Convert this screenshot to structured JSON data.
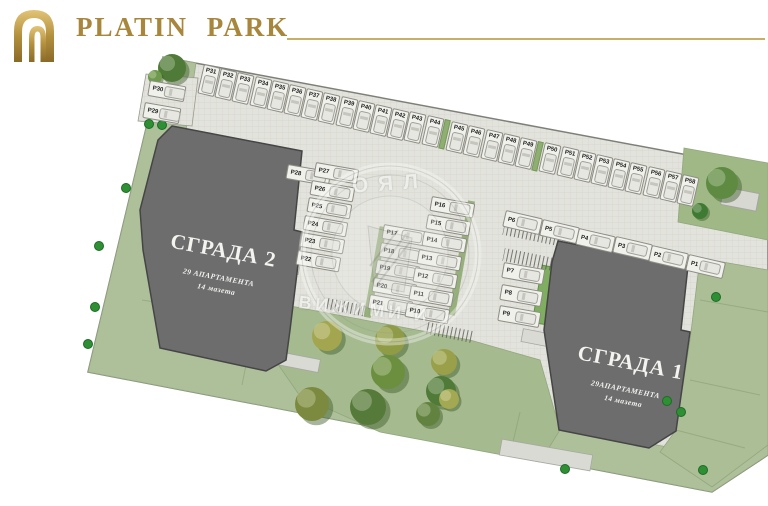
{
  "header": {
    "brand": "PLATIN PARK"
  },
  "watermark": {
    "arc_text": "ОЯЛ",
    "band_text": "ВИЖИМИ И"
  },
  "buildings": {
    "b2": {
      "name": "СГРАДА 2",
      "line1": "29 АПАРТАМЕНТА",
      "line2": "14 мазета"
    },
    "b1": {
      "name": "СГРАДА 1",
      "line1": "29АПАРТАМЕНТА",
      "line2": "14 мазета"
    }
  },
  "parking": {
    "top_row": [
      "P31",
      "P32",
      "P33",
      "P34",
      "P35",
      "P36",
      "P37",
      "P38",
      "P39",
      "P40",
      "P41",
      "P42",
      "P43",
      "P44",
      "P45",
      "P46",
      "P47",
      "P48",
      "P49",
      "P50",
      "P51",
      "P52",
      "P53",
      "P54",
      "P55",
      "P56",
      "P57",
      "P58"
    ],
    "left_edge": [
      "P30",
      "P29"
    ],
    "col_single": [
      "P28"
    ],
    "col_a": [
      "P27",
      "P26",
      "P25",
      "P24",
      "P23",
      "P22"
    ],
    "col_b": [
      "P17",
      "P18",
      "P19",
      "P20",
      "P21"
    ],
    "col_c": [
      "P16",
      "P15",
      "P14",
      "P13",
      "P12",
      "P11",
      "P10"
    ],
    "b1_col": [
      "P7",
      "P8",
      "P9"
    ],
    "b1_row": [
      "P6",
      "P5",
      "P4",
      "P3",
      "P2",
      "P1"
    ]
  },
  "colors": {
    "gold": "#a8863c",
    "gold_line": "#c8ae66",
    "grass": "#b2c39b",
    "paving": "#e3e3dd",
    "building": "#6d6d6d",
    "bush": "#2f8f35"
  }
}
